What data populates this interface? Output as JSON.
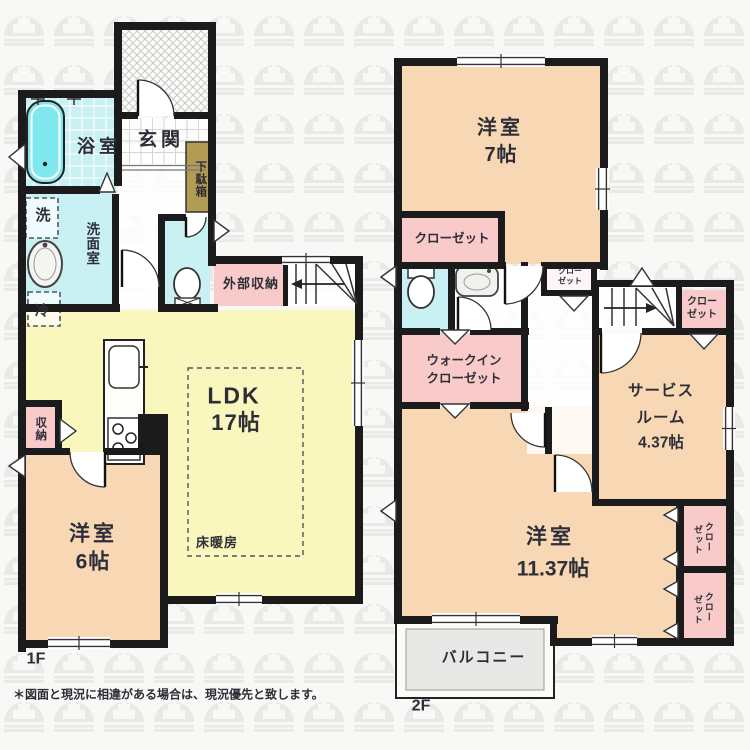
{
  "floor1": {
    "label": "1F",
    "rooms": {
      "bath": "浴室",
      "entrance": "玄関",
      "shoe_cabinet": "下駄箱",
      "washer": "洗",
      "washroom": "洗面室",
      "fridge": "冷",
      "exterior_storage": "外部収納",
      "ldk_name": "LDK",
      "ldk_size": "17帖",
      "floor_heating": "床暖房",
      "storage": "収納",
      "bedroom6_name": "洋室",
      "bedroom6_size": "6帖"
    }
  },
  "floor2": {
    "label": "2F",
    "rooms": {
      "bedroom7_name": "洋室",
      "bedroom7_size": "7帖",
      "closet": "クローゼット",
      "closet_line1": "クロー",
      "closet_line2": "ゼット",
      "wic_line1": "ウォークイン",
      "wic_line2": "クローゼット",
      "service_line1": "サービス",
      "service_line2": "ルーム",
      "service_size": "4.37帖",
      "bedroom11_name": "洋室",
      "bedroom11_size": "11.37帖",
      "balcony": "バルコニー"
    }
  },
  "note": "＊図面と現況に相違がある場合は、現況優先と致します。",
  "colors": {
    "wall": "#1b1b1b",
    "tatami_room": "#f8d8b4",
    "closet": "#f9caca",
    "wet_area": "#c9f0f3",
    "ldk": "#f9f6be",
    "bathtub": "#7fe7ee",
    "shoe_cabinet": "#b29b52",
    "balcony": "#e8e8e6",
    "watermark": "#e9e9e7",
    "text": "#2e2e38"
  }
}
